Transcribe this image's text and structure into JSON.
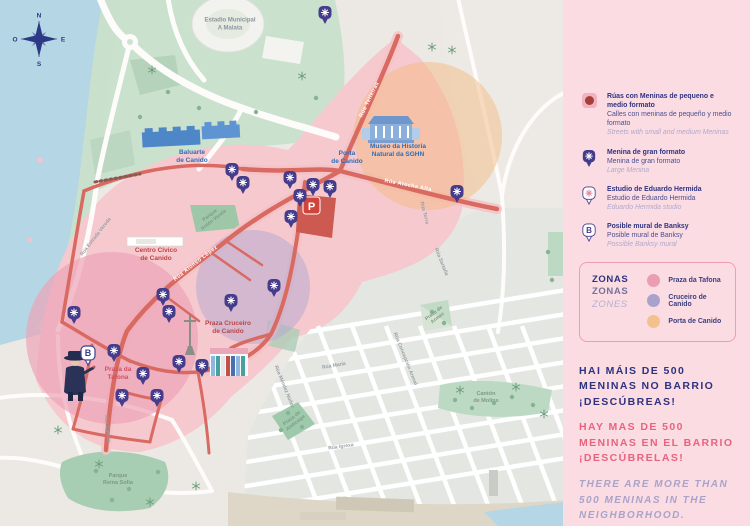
{
  "panel": {
    "legend": [
      {
        "icon": "small-meninas-streets-icon",
        "gl": "Rúas con Meninas de pequeno e medio formato",
        "es": "Calles con meninas de pequeño y medio formato",
        "en": "Streets with small and medium Meninas"
      },
      {
        "icon": "large-menina-pin-icon",
        "gl": "Menina de gran formato",
        "es": "Menina de gran formato",
        "en": "Large Menina"
      },
      {
        "icon": "hermida-studio-pin-icon",
        "gl": "Estudio de Eduardo Hermida",
        "es": "Estudio de Eduardo Hermida",
        "en": "Eduardo Hermida studio"
      },
      {
        "icon": "banksy-pin-icon",
        "gl": "Posible mural de Banksy",
        "es": "Posible mural de Banksy",
        "en": "Possible Banksy mural"
      }
    ],
    "legend_icons": {
      "banksy_letter": "B"
    },
    "zones_box": {
      "title_gl": "ZONAS",
      "title_es": "ZONAS",
      "title_en": "ZONES",
      "zones": [
        {
          "label": "Praza da Tafona",
          "color": "#eb9db3"
        },
        {
          "label": "Cruceiro de Canido",
          "color": "#a9a2cd"
        },
        {
          "label": "Porta de Canido",
          "color": "#f3c28c"
        }
      ]
    },
    "message": {
      "gl": "HAI MÁIS DE 500\nMENINAS NO BARRIO\n¡DESCÚBREAS!",
      "es": "HAY MAS DE 500\nMENINAS EN EL BARRIO\n¡DESCÚBRELAS!",
      "en": "THERE ARE MORE THAN\n500 MENINAS IN THE\nNEIGHBORHOOD.\nDISCOVER THEM!"
    }
  },
  "map": {
    "compass": {
      "n": "N",
      "s": "S",
      "e": "E",
      "w": "O"
    },
    "parking": {
      "label": "P",
      "x": 311,
      "y": 206
    },
    "banksy": {
      "label": "B",
      "x": 88,
      "y": 365
    },
    "colors": {
      "water": "#b5d6e4",
      "park": "#cae1ce",
      "pink_zone": "#f6c9ce",
      "tafona_zone": "#eca4b8",
      "cruceiro_zone": "#b1a7d0",
      "porta_zone": "#f3b983",
      "red_road": "#d96a62",
      "pin_purple": "#453d8c",
      "navy": "#2e3380",
      "accent_pink": "#e8637d"
    },
    "labels": [
      {
        "t": "Estadio Municipal\nA Malata",
        "x": 230,
        "y": 25,
        "r": 0,
        "c": "lbl-gray",
        "s": 6
      },
      {
        "t": "Baluarte\nde Canido",
        "x": 192,
        "y": 157,
        "r": 0,
        "c": "lbl-blue",
        "s": 6.5
      },
      {
        "t": "Porta\nde Canido",
        "x": 347,
        "y": 158,
        "r": 0,
        "c": "lbl-blue",
        "s": 6.5
      },
      {
        "t": "Museo da Historia\nNatural da SGHN",
        "x": 398,
        "y": 151,
        "r": 0,
        "c": "lbl-blue",
        "s": 6.5
      },
      {
        "t": "Centro Cívico\nde Canido",
        "x": 156,
        "y": 255,
        "r": 0,
        "c": "lbl-darkred",
        "s": 6.5
      },
      {
        "t": "Praza Cruceiro\nde Canido",
        "x": 228,
        "y": 328,
        "r": 0,
        "c": "lbl-darkred",
        "s": 6.5
      },
      {
        "t": "Praza da\nTafona",
        "x": 118,
        "y": 374,
        "r": 0,
        "c": "lbl-red",
        "s": 6.5
      },
      {
        "t": "Parque\nAntón Varela",
        "x": 212,
        "y": 218,
        "r": -38,
        "c": "lbl-green",
        "s": 5
      },
      {
        "t": "Praza de\nAmboage",
        "x": 294,
        "y": 421,
        "r": -38,
        "c": "lbl-green",
        "s": 5
      },
      {
        "t": "Praza de\nArmas",
        "x": 436,
        "y": 316,
        "r": -38,
        "c": "lbl-green",
        "s": 5
      },
      {
        "t": "Cantón\nde Molíns",
        "x": 486,
        "y": 398,
        "r": 0,
        "c": "lbl-green",
        "s": 5.5
      },
      {
        "t": "Parque\nReina Sofía",
        "x": 118,
        "y": 480,
        "r": 0,
        "c": "lbl-green",
        "s": 5.5
      },
      {
        "t": "Rúa Estrada Vereda",
        "x": 96,
        "y": 237,
        "r": -52,
        "c": "lbl-street",
        "s": 5
      },
      {
        "t": "Rúa Alonso López",
        "x": 196,
        "y": 264,
        "r": -38,
        "c": "lbl-white",
        "s": 5.5
      },
      {
        "t": "Rúa Telleiras",
        "x": 370,
        "y": 100,
        "r": -64,
        "c": "lbl-white",
        "s": 5.5
      },
      {
        "t": "Rúa Atocha Alta",
        "x": 408,
        "y": 186,
        "r": 11,
        "c": "lbl-white",
        "s": 5.5
      },
      {
        "t": "Rúa Terra",
        "x": 424,
        "y": 213,
        "r": 76,
        "c": "lbl-street",
        "s": 5
      },
      {
        "t": "Rúa Sartaña",
        "x": 441,
        "y": 262,
        "r": 68,
        "c": "lbl-street",
        "s": 5
      },
      {
        "t": "Rúa María",
        "x": 334,
        "y": 366,
        "r": -10,
        "c": "lbl-street",
        "s": 5
      },
      {
        "t": "Rúa Concepción Arenal",
        "x": 405,
        "y": 359,
        "r": 68,
        "c": "lbl-street",
        "s": 5
      },
      {
        "t": "Rúa Méndez Núñez",
        "x": 284,
        "y": 387,
        "r": 68,
        "c": "lbl-street",
        "s": 5
      },
      {
        "t": "Rúa Igrexa",
        "x": 341,
        "y": 447,
        "r": -8,
        "c": "lbl-street",
        "s": 5
      },
      {
        "t": "Rúa Canido",
        "x": 107,
        "y": 429,
        "r": 84,
        "c": "lbl-street",
        "s": 5
      }
    ],
    "pins": [
      {
        "x": 325,
        "y": 24
      },
      {
        "x": 232,
        "y": 181
      },
      {
        "x": 243,
        "y": 194
      },
      {
        "x": 290,
        "y": 189
      },
      {
        "x": 313,
        "y": 196
      },
      {
        "x": 330,
        "y": 198
      },
      {
        "x": 300,
        "y": 207
      },
      {
        "x": 291,
        "y": 228
      },
      {
        "x": 457,
        "y": 203
      },
      {
        "x": 163,
        "y": 306
      },
      {
        "x": 169,
        "y": 323
      },
      {
        "x": 231,
        "y": 312
      },
      {
        "x": 274,
        "y": 297
      },
      {
        "x": 74,
        "y": 324
      },
      {
        "x": 114,
        "y": 362
      },
      {
        "x": 143,
        "y": 385
      },
      {
        "x": 122,
        "y": 407
      },
      {
        "x": 157,
        "y": 407
      },
      {
        "x": 179,
        "y": 373
      },
      {
        "x": 202,
        "y": 377
      }
    ],
    "trees": {
      "stars": [
        [
          152,
          70
        ],
        [
          302,
          76
        ],
        [
          452,
          50
        ],
        [
          99,
          464
        ],
        [
          150,
          502
        ],
        [
          196,
          486
        ],
        [
          460,
          390
        ],
        [
          516,
          387
        ],
        [
          544,
          414
        ],
        [
          432,
          47
        ],
        [
          58,
          430
        ]
      ],
      "dots": [
        [
          168,
          92
        ],
        [
          199,
          108
        ],
        [
          256,
          112
        ],
        [
          140,
          117
        ],
        [
          316,
          98
        ],
        [
          288,
          413
        ],
        [
          302,
          427
        ],
        [
          281,
          430
        ],
        [
          432,
          312
        ],
        [
          444,
          323
        ],
        [
          455,
          400
        ],
        [
          472,
          408
        ],
        [
          494,
          403
        ],
        [
          512,
          397
        ],
        [
          533,
          405
        ],
        [
          96,
          471
        ],
        [
          129,
          489
        ],
        [
          158,
          472
        ],
        [
          112,
          500
        ],
        [
          548,
          252
        ],
        [
          552,
          280
        ]
      ]
    }
  }
}
